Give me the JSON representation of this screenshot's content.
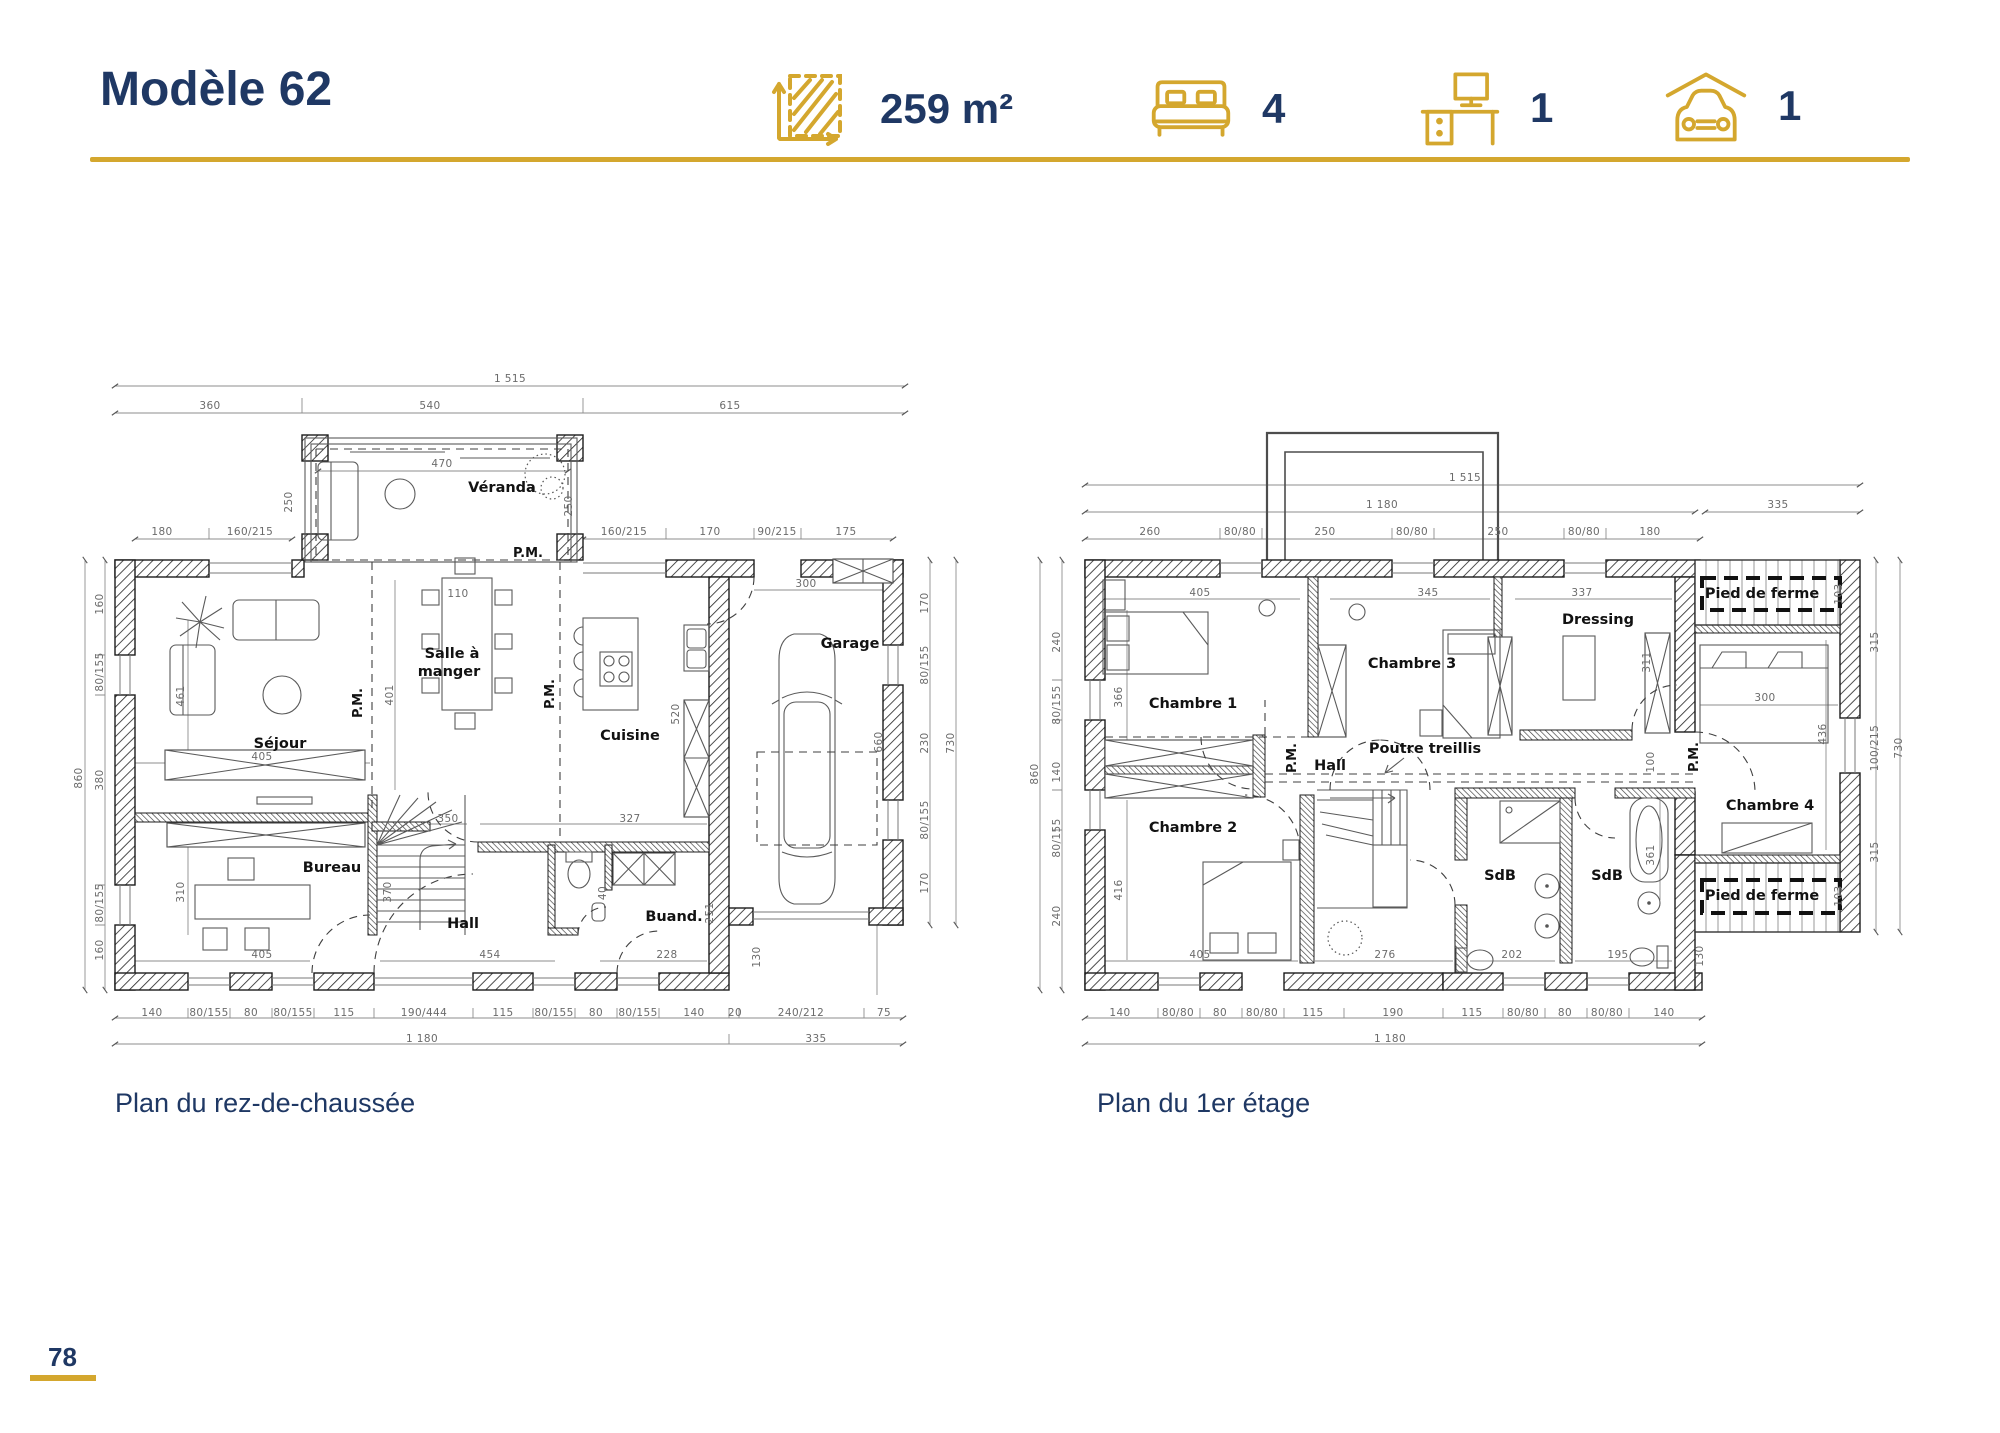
{
  "header": {
    "title": "Modèle 62",
    "stats": [
      {
        "icon": "area-icon",
        "value": "259 m²"
      },
      {
        "icon": "bed-icon",
        "value": "4"
      },
      {
        "icon": "desk-icon",
        "value": "1"
      },
      {
        "icon": "car-garage-icon",
        "value": "1"
      }
    ]
  },
  "captions": {
    "ground": "Plan du rez-de-chaussée",
    "first": "Plan du 1er étage"
  },
  "page_number": "78",
  "colors": {
    "navy": "#1f3864",
    "gold": "#d4a72e",
    "wall_line": "#1c1c1c",
    "dim_text": "#6b6b6b"
  },
  "ground_floor": {
    "labels": [
      {
        "t": "Véranda",
        "x": 502,
        "y": 492,
        "c": "room"
      },
      {
        "t": "Séjour",
        "x": 280,
        "y": 748,
        "c": "room"
      },
      {
        "t": "Salle à",
        "x": 452,
        "y": 658,
        "c": "room"
      },
      {
        "t": "manger",
        "x": 449,
        "y": 676,
        "c": "room"
      },
      {
        "t": "Cuisine",
        "x": 630,
        "y": 740,
        "c": "room"
      },
      {
        "t": "Garage",
        "x": 850,
        "y": 648,
        "c": "room"
      },
      {
        "t": "Bureau",
        "x": 332,
        "y": 872,
        "c": "room"
      },
      {
        "t": "Hall",
        "x": 463,
        "y": 928,
        "c": "room"
      },
      {
        "t": "Buand.",
        "x": 674,
        "y": 921,
        "c": "room"
      },
      {
        "t": "P.M.",
        "x": 528,
        "y": 557,
        "c": "pm"
      },
      {
        "t": "P.M.",
        "x": 362,
        "y": 703,
        "r": 1,
        "c": "pm"
      },
      {
        "t": "P.M.",
        "x": 554,
        "y": 694,
        "r": 1,
        "c": "pm"
      },
      {
        "t": "1 515",
        "x": 510,
        "y": 382
      },
      {
        "t": "360",
        "x": 210,
        "y": 409
      },
      {
        "t": "540",
        "x": 430,
        "y": 409
      },
      {
        "t": "615",
        "x": 730,
        "y": 409
      },
      {
        "t": "470",
        "x": 442,
        "y": 467
      },
      {
        "t": "250",
        "x": 292,
        "y": 502,
        "r": 1
      },
      {
        "t": "250",
        "x": 572,
        "y": 506,
        "r": 1
      },
      {
        "t": "180",
        "x": 162,
        "y": 535
      },
      {
        "t": "160/215",
        "x": 250,
        "y": 535
      },
      {
        "t": "160/215",
        "x": 624,
        "y": 535
      },
      {
        "t": "170",
        "x": 710,
        "y": 535
      },
      {
        "t": "90/215",
        "x": 777,
        "y": 535
      },
      {
        "t": "175",
        "x": 846,
        "y": 535
      },
      {
        "t": "160",
        "x": 103,
        "y": 604,
        "r": 1
      },
      {
        "t": "80/155",
        "x": 103,
        "y": 672,
        "r": 1
      },
      {
        "t": "380",
        "x": 103,
        "y": 780,
        "r": 1
      },
      {
        "t": "80/155",
        "x": 103,
        "y": 903,
        "r": 1
      },
      {
        "t": "160",
        "x": 103,
        "y": 950,
        "r": 1
      },
      {
        "t": "860",
        "x": 82,
        "y": 778,
        "r": 1
      },
      {
        "t": "110",
        "x": 458,
        "y": 597
      },
      {
        "t": "401",
        "x": 393,
        "y": 695,
        "r": 1
      },
      {
        "t": "461",
        "x": 184,
        "y": 696,
        "r": 1
      },
      {
        "t": "405",
        "x": 262,
        "y": 760
      },
      {
        "t": "310",
        "x": 184,
        "y": 892,
        "r": 1
      },
      {
        "t": "405",
        "x": 262,
        "y": 958
      },
      {
        "t": "350",
        "x": 448,
        "y": 822
      },
      {
        "t": "327",
        "x": 630,
        "y": 822
      },
      {
        "t": "370",
        "x": 391,
        "y": 892,
        "r": 1
      },
      {
        "t": "454",
        "x": 490,
        "y": 958
      },
      {
        "t": "520",
        "x": 679,
        "y": 714,
        "r": 1
      },
      {
        "t": "40",
        "x": 606,
        "y": 893,
        "r": 1
      },
      {
        "t": "228",
        "x": 667,
        "y": 958
      },
      {
        "t": "251",
        "x": 713,
        "y": 913,
        "r": 1
      },
      {
        "t": "130",
        "x": 760,
        "y": 957,
        "r": 1
      },
      {
        "t": "300",
        "x": 806,
        "y": 587
      },
      {
        "t": "660",
        "x": 882,
        "y": 742,
        "r": 1
      },
      {
        "t": "170",
        "x": 928,
        "y": 603,
        "r": 1
      },
      {
        "t": "80/155",
        "x": 928,
        "y": 665,
        "r": 1
      },
      {
        "t": "230",
        "x": 928,
        "y": 743,
        "r": 1
      },
      {
        "t": "80/155",
        "x": 928,
        "y": 820,
        "r": 1
      },
      {
        "t": "170",
        "x": 928,
        "y": 883,
        "r": 1
      },
      {
        "t": "730",
        "x": 954,
        "y": 743,
        "r": 1
      },
      {
        "t": "140",
        "x": 152,
        "y": 1016
      },
      {
        "t": "80/155",
        "x": 209,
        "y": 1016
      },
      {
        "t": "80",
        "x": 251,
        "y": 1016
      },
      {
        "t": "80/155",
        "x": 293,
        "y": 1016
      },
      {
        "t": "115",
        "x": 344,
        "y": 1016
      },
      {
        "t": "190/444",
        "x": 424,
        "y": 1016
      },
      {
        "t": "115",
        "x": 503,
        "y": 1016
      },
      {
        "t": "80/155",
        "x": 554,
        "y": 1016
      },
      {
        "t": "80",
        "x": 596,
        "y": 1016
      },
      {
        "t": "80/155",
        "x": 638,
        "y": 1016
      },
      {
        "t": "140",
        "x": 694,
        "y": 1016
      },
      {
        "t": "20",
        "x": 735,
        "y": 1016
      },
      {
        "t": "240/212",
        "x": 801,
        "y": 1016
      },
      {
        "t": "75",
        "x": 884,
        "y": 1016
      },
      {
        "t": "1 180",
        "x": 422,
        "y": 1042
      },
      {
        "t": "335",
        "x": 816,
        "y": 1042
      }
    ]
  },
  "first_floor": {
    "labels": [
      {
        "t": "Chambre 1",
        "x": 1193,
        "y": 708,
        "c": "room"
      },
      {
        "t": "Chambre 2",
        "x": 1193,
        "y": 832,
        "c": "room"
      },
      {
        "t": "Chambre 3",
        "x": 1412,
        "y": 668,
        "c": "room"
      },
      {
        "t": "Chambre 4",
        "x": 1770,
        "y": 810,
        "c": "room"
      },
      {
        "t": "Dressing",
        "x": 1598,
        "y": 624,
        "c": "room"
      },
      {
        "t": "Hall",
        "x": 1330,
        "y": 770,
        "c": "room"
      },
      {
        "t": "SdB",
        "x": 1500,
        "y": 880,
        "c": "room"
      },
      {
        "t": "SdB",
        "x": 1607,
        "y": 880,
        "c": "room"
      },
      {
        "t": "Poutre treillis",
        "x": 1425,
        "y": 753,
        "c": "room"
      },
      {
        "t": "Pied de ferme",
        "x": 1762,
        "y": 598,
        "c": "room"
      },
      {
        "t": "Pied de ferme",
        "x": 1762,
        "y": 900,
        "c": "room"
      },
      {
        "t": "P.M.",
        "x": 1296,
        "y": 758,
        "r": 1,
        "c": "pm"
      },
      {
        "t": "P.M.",
        "x": 1698,
        "y": 757,
        "r": 1,
        "c": "pm"
      },
      {
        "t": "1 515",
        "x": 1465,
        "y": 481
      },
      {
        "t": "1 180",
        "x": 1382,
        "y": 508
      },
      {
        "t": "335",
        "x": 1778,
        "y": 508
      },
      {
        "t": "260",
        "x": 1150,
        "y": 535
      },
      {
        "t": "80/80",
        "x": 1240,
        "y": 535
      },
      {
        "t": "250",
        "x": 1325,
        "y": 535
      },
      {
        "t": "80/80",
        "x": 1412,
        "y": 535
      },
      {
        "t": "250",
        "x": 1498,
        "y": 535
      },
      {
        "t": "80/80",
        "x": 1584,
        "y": 535
      },
      {
        "t": "180",
        "x": 1650,
        "y": 535
      },
      {
        "t": "240",
        "x": 1060,
        "y": 642,
        "r": 1
      },
      {
        "t": "80/155",
        "x": 1060,
        "y": 705,
        "r": 1
      },
      {
        "t": "140",
        "x": 1060,
        "y": 772,
        "r": 1
      },
      {
        "t": "80/155",
        "x": 1060,
        "y": 838,
        "r": 1
      },
      {
        "t": "240",
        "x": 1060,
        "y": 916,
        "r": 1
      },
      {
        "t": "860",
        "x": 1038,
        "y": 774,
        "r": 1
      },
      {
        "t": "405",
        "x": 1200,
        "y": 596
      },
      {
        "t": "366",
        "x": 1122,
        "y": 697,
        "r": 1
      },
      {
        "t": "345",
        "x": 1428,
        "y": 596
      },
      {
        "t": "337",
        "x": 1582,
        "y": 596
      },
      {
        "t": "311",
        "x": 1650,
        "y": 662,
        "r": 1
      },
      {
        "t": "405",
        "x": 1200,
        "y": 958
      },
      {
        "t": "416",
        "x": 1122,
        "y": 890,
        "r": 1
      },
      {
        "t": "276",
        "x": 1385,
        "y": 958
      },
      {
        "t": "202",
        "x": 1512,
        "y": 958
      },
      {
        "t": "195",
        "x": 1618,
        "y": 958
      },
      {
        "t": "361",
        "x": 1654,
        "y": 855,
        "r": 1
      },
      {
        "t": "100",
        "x": 1654,
        "y": 762,
        "r": 1
      },
      {
        "t": "300",
        "x": 1765,
        "y": 701
      },
      {
        "t": "436",
        "x": 1826,
        "y": 734,
        "r": 1
      },
      {
        "t": "103",
        "x": 1842,
        "y": 594,
        "r": 1
      },
      {
        "t": "103",
        "x": 1842,
        "y": 896,
        "r": 1
      },
      {
        "t": "130",
        "x": 1703,
        "y": 956,
        "r": 1
      },
      {
        "t": "315",
        "x": 1878,
        "y": 642,
        "r": 1
      },
      {
        "t": "100/215",
        "x": 1878,
        "y": 748,
        "r": 1
      },
      {
        "t": "315",
        "x": 1878,
        "y": 852,
        "r": 1
      },
      {
        "t": "730",
        "x": 1902,
        "y": 748,
        "r": 1
      },
      {
        "t": "140",
        "x": 1120,
        "y": 1016
      },
      {
        "t": "80/80",
        "x": 1178,
        "y": 1016
      },
      {
        "t": "80",
        "x": 1220,
        "y": 1016
      },
      {
        "t": "80/80",
        "x": 1262,
        "y": 1016
      },
      {
        "t": "115",
        "x": 1313,
        "y": 1016
      },
      {
        "t": "190",
        "x": 1393,
        "y": 1016
      },
      {
        "t": "115",
        "x": 1472,
        "y": 1016
      },
      {
        "t": "80/80",
        "x": 1523,
        "y": 1016
      },
      {
        "t": "80",
        "x": 1565,
        "y": 1016
      },
      {
        "t": "80/80",
        "x": 1607,
        "y": 1016
      },
      {
        "t": "140",
        "x": 1664,
        "y": 1016
      },
      {
        "t": "1 180",
        "x": 1390,
        "y": 1042
      }
    ]
  }
}
